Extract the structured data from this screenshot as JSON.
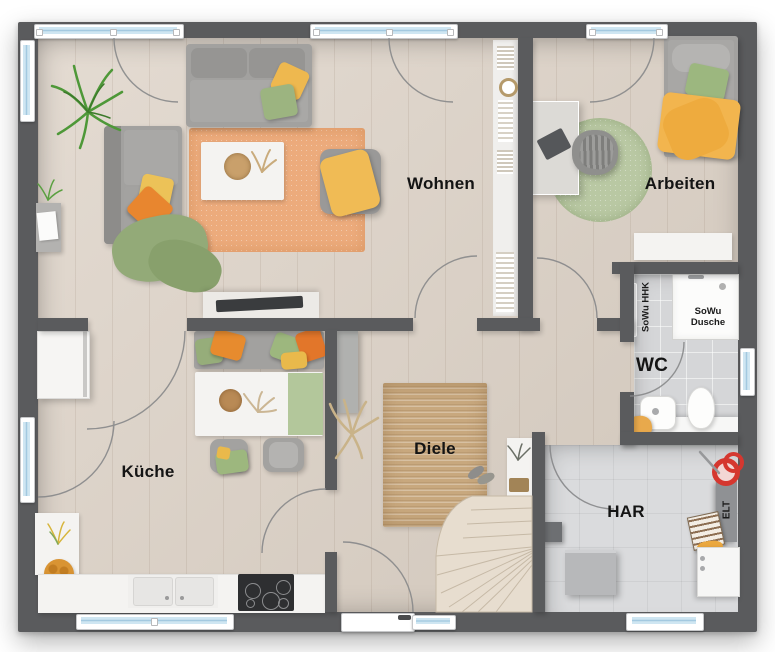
{
  "floorplan": {
    "room_labels": {
      "wohnen": "Wohnen",
      "arbeiten": "Arbeiten",
      "kueche": "Küche",
      "diele": "Diele",
      "wc": "WC",
      "har": "HAR"
    },
    "annotation_labels": {
      "sowu_dusche": "SoWu Dusche",
      "sowu_hhk": "SoWu HHK",
      "elt": "ELT"
    },
    "colors": {
      "wall": "#5a5b5d",
      "wood_floor": "#dcd1c5",
      "tile_floor_wc": "#d5d6d8",
      "tile_floor_har": "#dadbdd",
      "rug_living": "#ecab7c",
      "rug_hall": "#c8a87e",
      "rug_office": "#b9c8a3",
      "accent_orange": "#e8862f",
      "accent_yellow": "#eeb84f",
      "accent_green": "#9cb480",
      "window_glass": "#b5d6ea",
      "stairs": "#e7ddcf"
    }
  }
}
